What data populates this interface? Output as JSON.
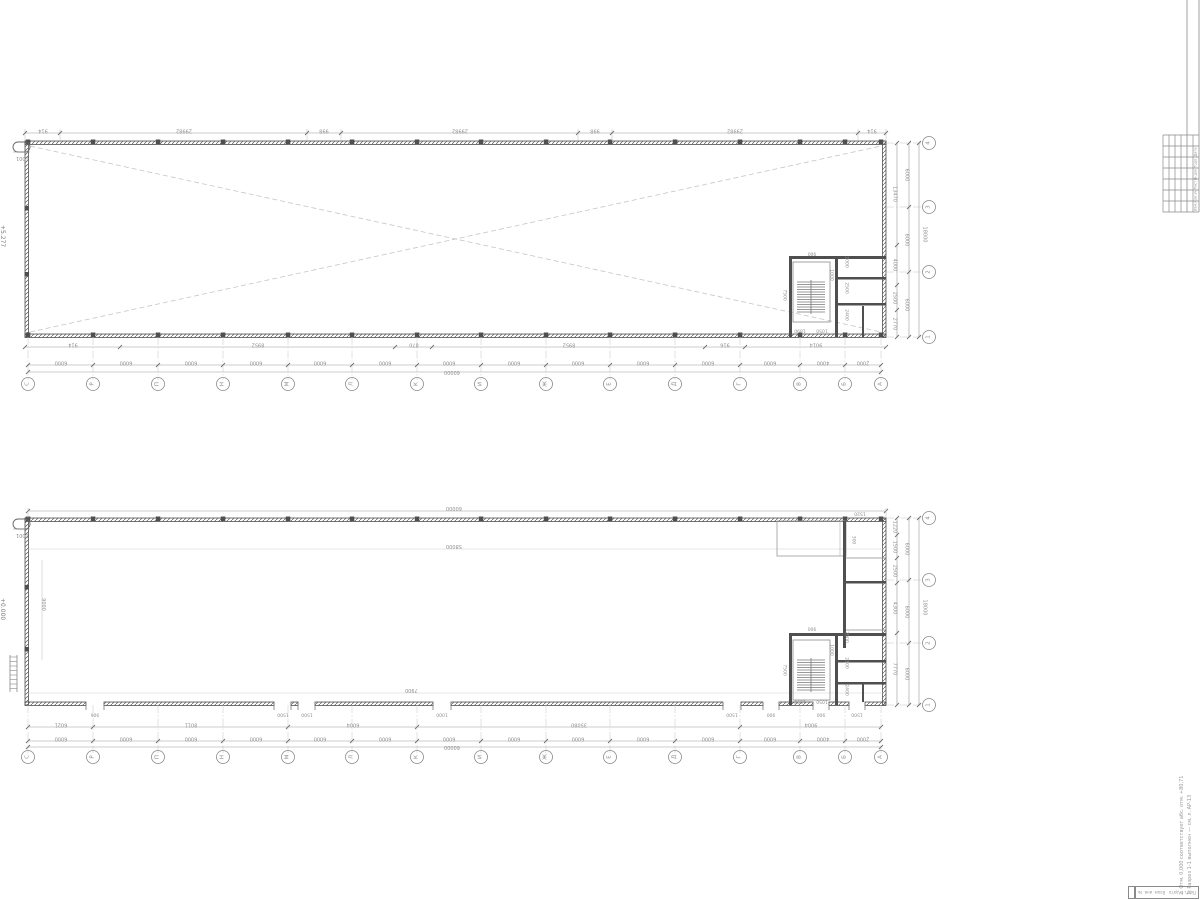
{
  "colors": {
    "wall": "#4f4f4f",
    "medium": "#9a9a9a",
    "thin": "#bcbcbc",
    "dash": "#c6c6c6",
    "text": "#8f8f8f"
  },
  "axes": {
    "letters": [
      "С",
      "Р",
      "П",
      "Н",
      "М",
      "Л",
      "К",
      "И",
      "Ж",
      "Е",
      "Д",
      "Г",
      "В",
      "Б",
      "А"
    ],
    "numbers": [
      "1",
      "2",
      "3",
      "4"
    ]
  },
  "plan_top": {
    "elevation": "+5.277",
    "corner_label": "1001",
    "dims_top": [
      "914",
      "29982",
      "998",
      "29982",
      "998",
      "29982",
      "914"
    ],
    "dims_bottom1": [
      "914",
      "8952",
      "870",
      "8952",
      "916",
      "9014"
    ],
    "dims_bottom2": [
      "6000",
      "6000",
      "6000",
      "6000",
      "6000",
      "6000",
      "6000",
      "6000",
      "6000",
      "6000",
      "6000",
      "6000",
      "4000",
      "2000"
    ],
    "dims_bottom_total": "60000",
    "right_inner": [
      "2770",
      "2500",
      "4000",
      "13470"
    ],
    "right_mid": [
      "6000",
      "6000",
      "6000"
    ],
    "right_total": "18000",
    "core_dims": [
      "7500",
      "2000",
      "2500",
      "2400",
      "900",
      "1890",
      "1050",
      "1000"
    ]
  },
  "plan_bottom": {
    "elevation": "+0.000",
    "corner_label": "1001",
    "dims_top_total": "60000",
    "inner_top_dim": "58000",
    "inner_bottom_dim": "7900",
    "inner_left_dim": "9000",
    "opening_dims": [
      "906",
      "1500",
      "1500",
      "1000",
      "1500",
      "900",
      "900",
      "1500"
    ],
    "dims_row2": [
      "6021",
      "8011",
      "6004",
      "35080",
      "9004"
    ],
    "dims_row3": [
      "6000",
      "6000",
      "6000",
      "6000",
      "6000",
      "6000",
      "6000",
      "6000",
      "6000",
      "6000",
      "6000",
      "6000",
      "4000",
      "2000"
    ],
    "dims_total": "60000",
    "right_inner": [
      "7770",
      "4300",
      "2500",
      "1500",
      "1220"
    ],
    "right_mid": [
      "6000",
      "6000",
      "6000"
    ],
    "right_total": "18000",
    "core_dims": [
      "7500",
      "2000",
      "2500",
      "2400",
      "900",
      "1890",
      "1050",
      "1000"
    ],
    "canopy_dims": [
      "1520",
      "300"
    ]
  },
  "titleblock": {
    "header_labels": [
      "Дата",
      "Подп.",
      "№ док.",
      "Лист",
      "Кол.уч.",
      "Изм."
    ],
    "strip_cells": [
      "Взам. инв. №",
      "Подп. и дата"
    ],
    "notes": [
      "1. Разрез 1-1 выполнен — см. л. АР-13",
      "2. Отм. 0,000 соответствует абс. отм. +80,71"
    ]
  }
}
